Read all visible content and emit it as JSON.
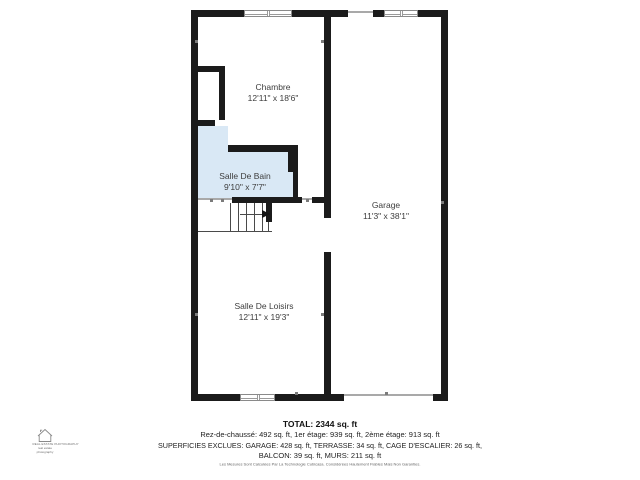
{
  "floor_plan": {
    "wall_color": "#1b1b1b",
    "bathroom_fill": "#d9e8f5",
    "rooms": [
      {
        "name": "Chambre",
        "dims": "12'11\" x 18'6\""
      },
      {
        "name": "Salle De Bain",
        "dims": "9'10\" x 7'7\""
      },
      {
        "name": "Garage",
        "dims": "11'3\" x 38'1\""
      },
      {
        "name": "Salle De Loisirs",
        "dims": "12'11\" x 19'3\""
      }
    ],
    "features": [
      "stairs",
      "windows",
      "garage-door-opening",
      "terrace-opening"
    ]
  },
  "summary": {
    "total": "TOTAL: 2344 sq. ft",
    "floors": "Rez-de-chaussé: 492 sq. ft, 1er étage: 939 sq. ft, 2ème étage: 913 sq. ft",
    "exclusions_line1": "SUPERFICIES EXCLUES: GARAGE: 428 sq. ft, TERRASSE: 34 sq. ft, CAGE D'ESCALIER: 26 sq. ft,",
    "exclusions_line2": "BALCON: 39 sq. ft, MURS: 211 sq. ft",
    "disclaimer": "Les Mesures Sont Calculées Par La Technologie Cubicasa. Considérées Hautement Fiables Mais Non Garanties."
  },
  "logo": {
    "line1": "REAL ESTATE PHOTOGRAPHY",
    "line2": "real estate",
    "line3": "photography"
  }
}
